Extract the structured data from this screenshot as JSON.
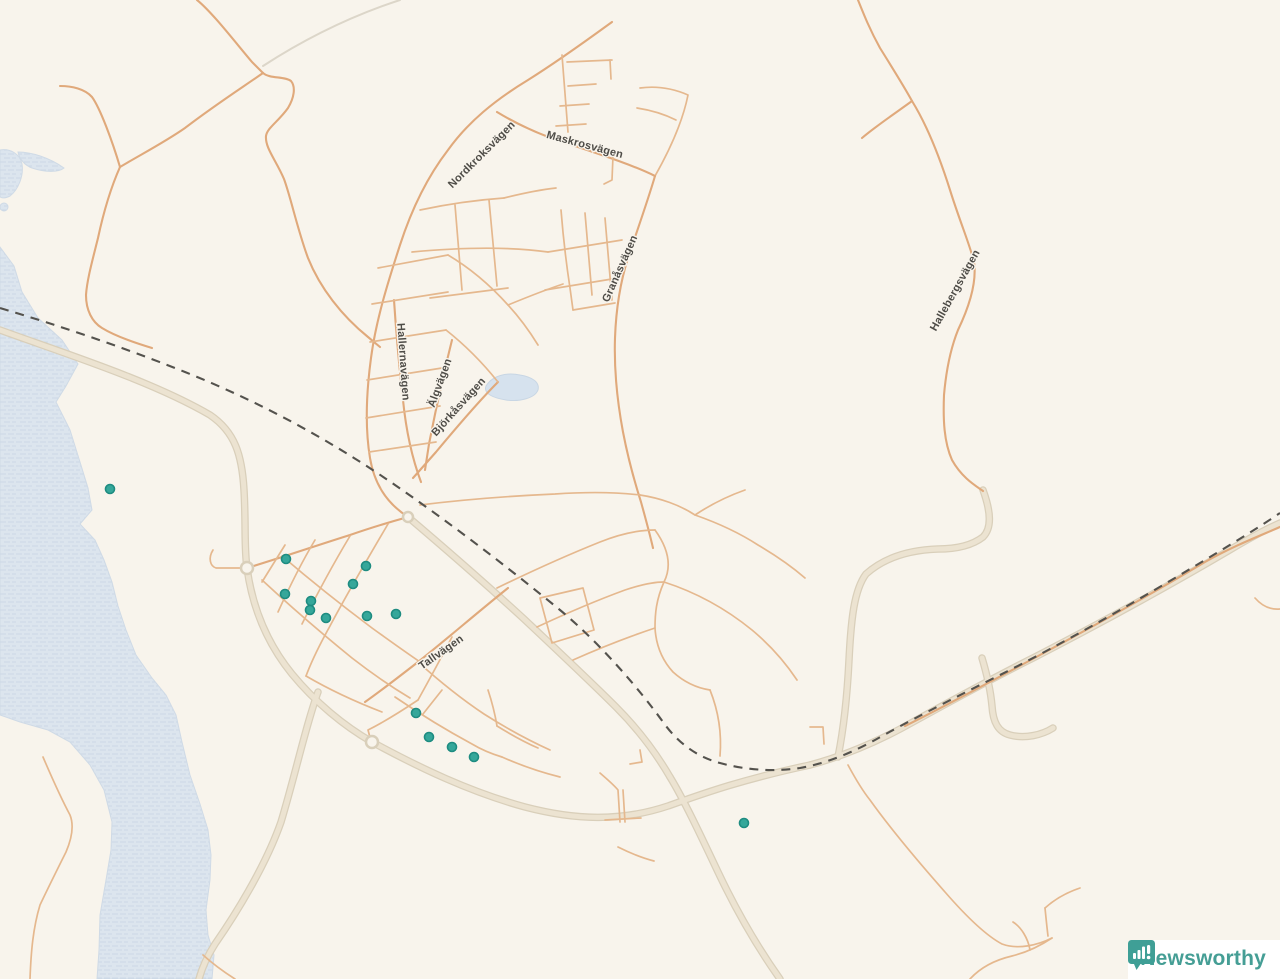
{
  "map": {
    "background_color": "#f8f4ec",
    "water_color": "#dce5ee",
    "road_major_color": "#ece3d1",
    "road_minor_color": "#e0a97b",
    "railway_color": "#54524d",
    "label_color": "#4e4c47",
    "street_labels": [
      {
        "name": "Nordkroksvägen",
        "x": 484,
        "y": 157,
        "rotation": -45
      },
      {
        "name": "Maskrosvägen",
        "x": 584,
        "y": 148,
        "rotation": 15
      },
      {
        "name": "Granåsvägen",
        "x": 623,
        "y": 270,
        "rotation": -66
      },
      {
        "name": "Hallernavägen",
        "x": 400,
        "y": 362,
        "rotation": 86
      },
      {
        "name": "Älgvägen",
        "x": 443,
        "y": 384,
        "rotation": -70
      },
      {
        "name": "Björkåsvägen",
        "x": 461,
        "y": 409,
        "rotation": -48
      },
      {
        "name": "Hallebergsvägen",
        "x": 958,
        "y": 292,
        "rotation": -61
      },
      {
        "name": "Tallvägen",
        "x": 443,
        "y": 655,
        "rotation": -35
      }
    ],
    "markers": {
      "color": "#35a79a",
      "border_color": "#1e8c81",
      "points": [
        {
          "x": 110,
          "y": 489
        },
        {
          "x": 286,
          "y": 559
        },
        {
          "x": 366,
          "y": 566
        },
        {
          "x": 353,
          "y": 584
        },
        {
          "x": 285,
          "y": 594
        },
        {
          "x": 311,
          "y": 601
        },
        {
          "x": 310,
          "y": 610
        },
        {
          "x": 326,
          "y": 618
        },
        {
          "x": 367,
          "y": 616
        },
        {
          "x": 396,
          "y": 614
        },
        {
          "x": 416,
          "y": 713
        },
        {
          "x": 429,
          "y": 737
        },
        {
          "x": 452,
          "y": 747
        },
        {
          "x": 474,
          "y": 757
        },
        {
          "x": 744,
          "y": 823
        }
      ]
    }
  },
  "logo": {
    "text": "Newsworthy",
    "color": "#459e95",
    "icon": "bar-chart-pin-icon"
  }
}
